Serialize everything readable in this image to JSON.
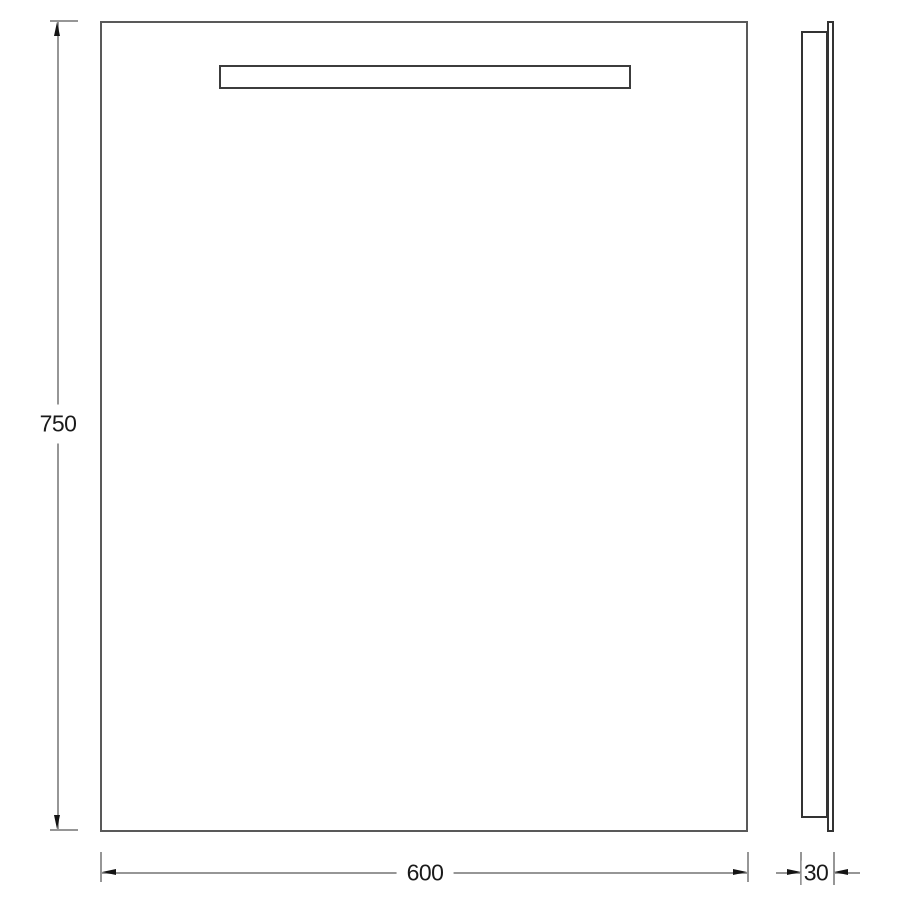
{
  "colors": {
    "background": "#ffffff",
    "front-outline": "#595959",
    "strip-outline": "#3c3c3c",
    "side-outline": "#333333",
    "dim-line": "#969696",
    "arrow": "#141414",
    "dim-text": "#1a1a1a"
  },
  "dimensions": {
    "height_label": "750",
    "width_label": "600",
    "depth_label": "30"
  }
}
